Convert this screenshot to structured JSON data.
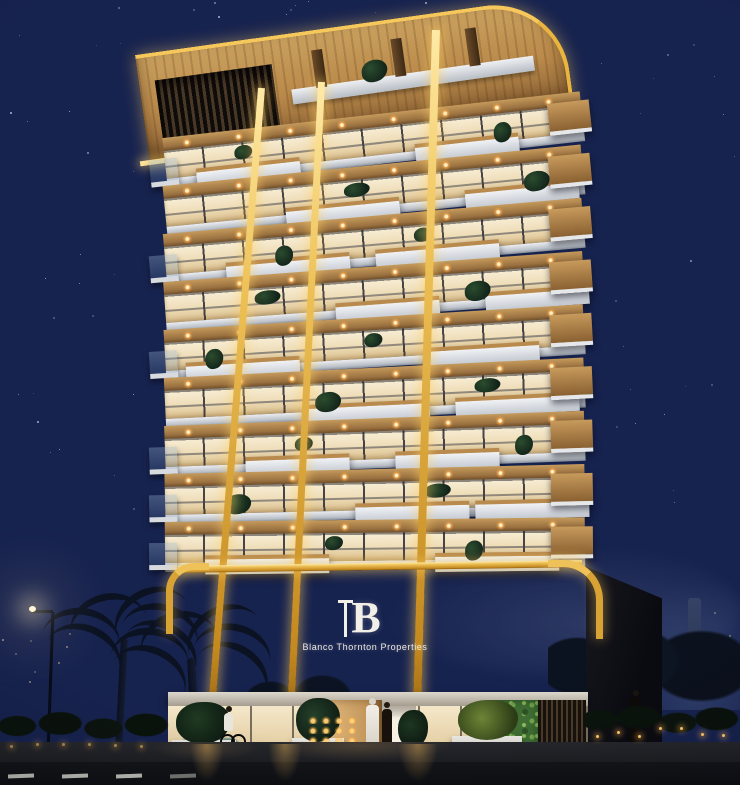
{
  "scene": {
    "type": "architectural-night-render",
    "description": "Luxury mid-rise residential tower at night with warm gold LED accent lighting, palm trees and street scene",
    "sky": {
      "top_color": "#15204b",
      "mid_color": "#1d2c5e",
      "horizon_color": "#4d5878",
      "stars_visible": true
    },
    "building": {
      "floor_count": 9,
      "sign": {
        "monogram": "B",
        "name": "Blanco Thornton Properties",
        "text_color": "#f2efe8"
      },
      "materials": {
        "wood": "#c29158",
        "wood_dark": "#7c5a33",
        "glass_warm": "#f4e6c8",
        "slab_white": "#d9dce1",
        "podium_dark": "#221a13",
        "accent_gold": "#eec258",
        "gold_glow": "#ffd97c",
        "green_wall": "#4c7a38"
      }
    },
    "environment": {
      "palm_trees": 2,
      "street_lamp": true,
      "people_count": 4,
      "city_lights_visible": true,
      "road_marking_color": "#d9d9d2"
    }
  }
}
